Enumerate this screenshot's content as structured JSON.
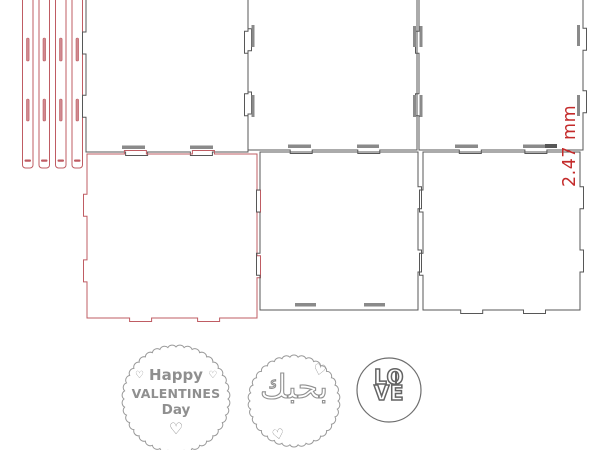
{
  "colors": {
    "cut_outline": "#575757",
    "cut_secondary": "#bf5c63",
    "hinge_slot_fill": "#d08a90",
    "engrave_gray": "#8a8a8a",
    "dimension_red": "#c42b2b",
    "badge_gray": "#8f8f8f",
    "love_gray": "#646464"
  },
  "annotation": {
    "dimension_label": "2.47 mm"
  },
  "badges": {
    "valentine": {
      "heart_glyph": "♡",
      "line1": "Happy",
      "line2": "VALENTINES",
      "line3": "Day"
    },
    "arabic": {
      "text": "بحبك",
      "heart_glyph": "♡"
    },
    "love": {
      "line1": "LO",
      "line2": "VE"
    }
  }
}
